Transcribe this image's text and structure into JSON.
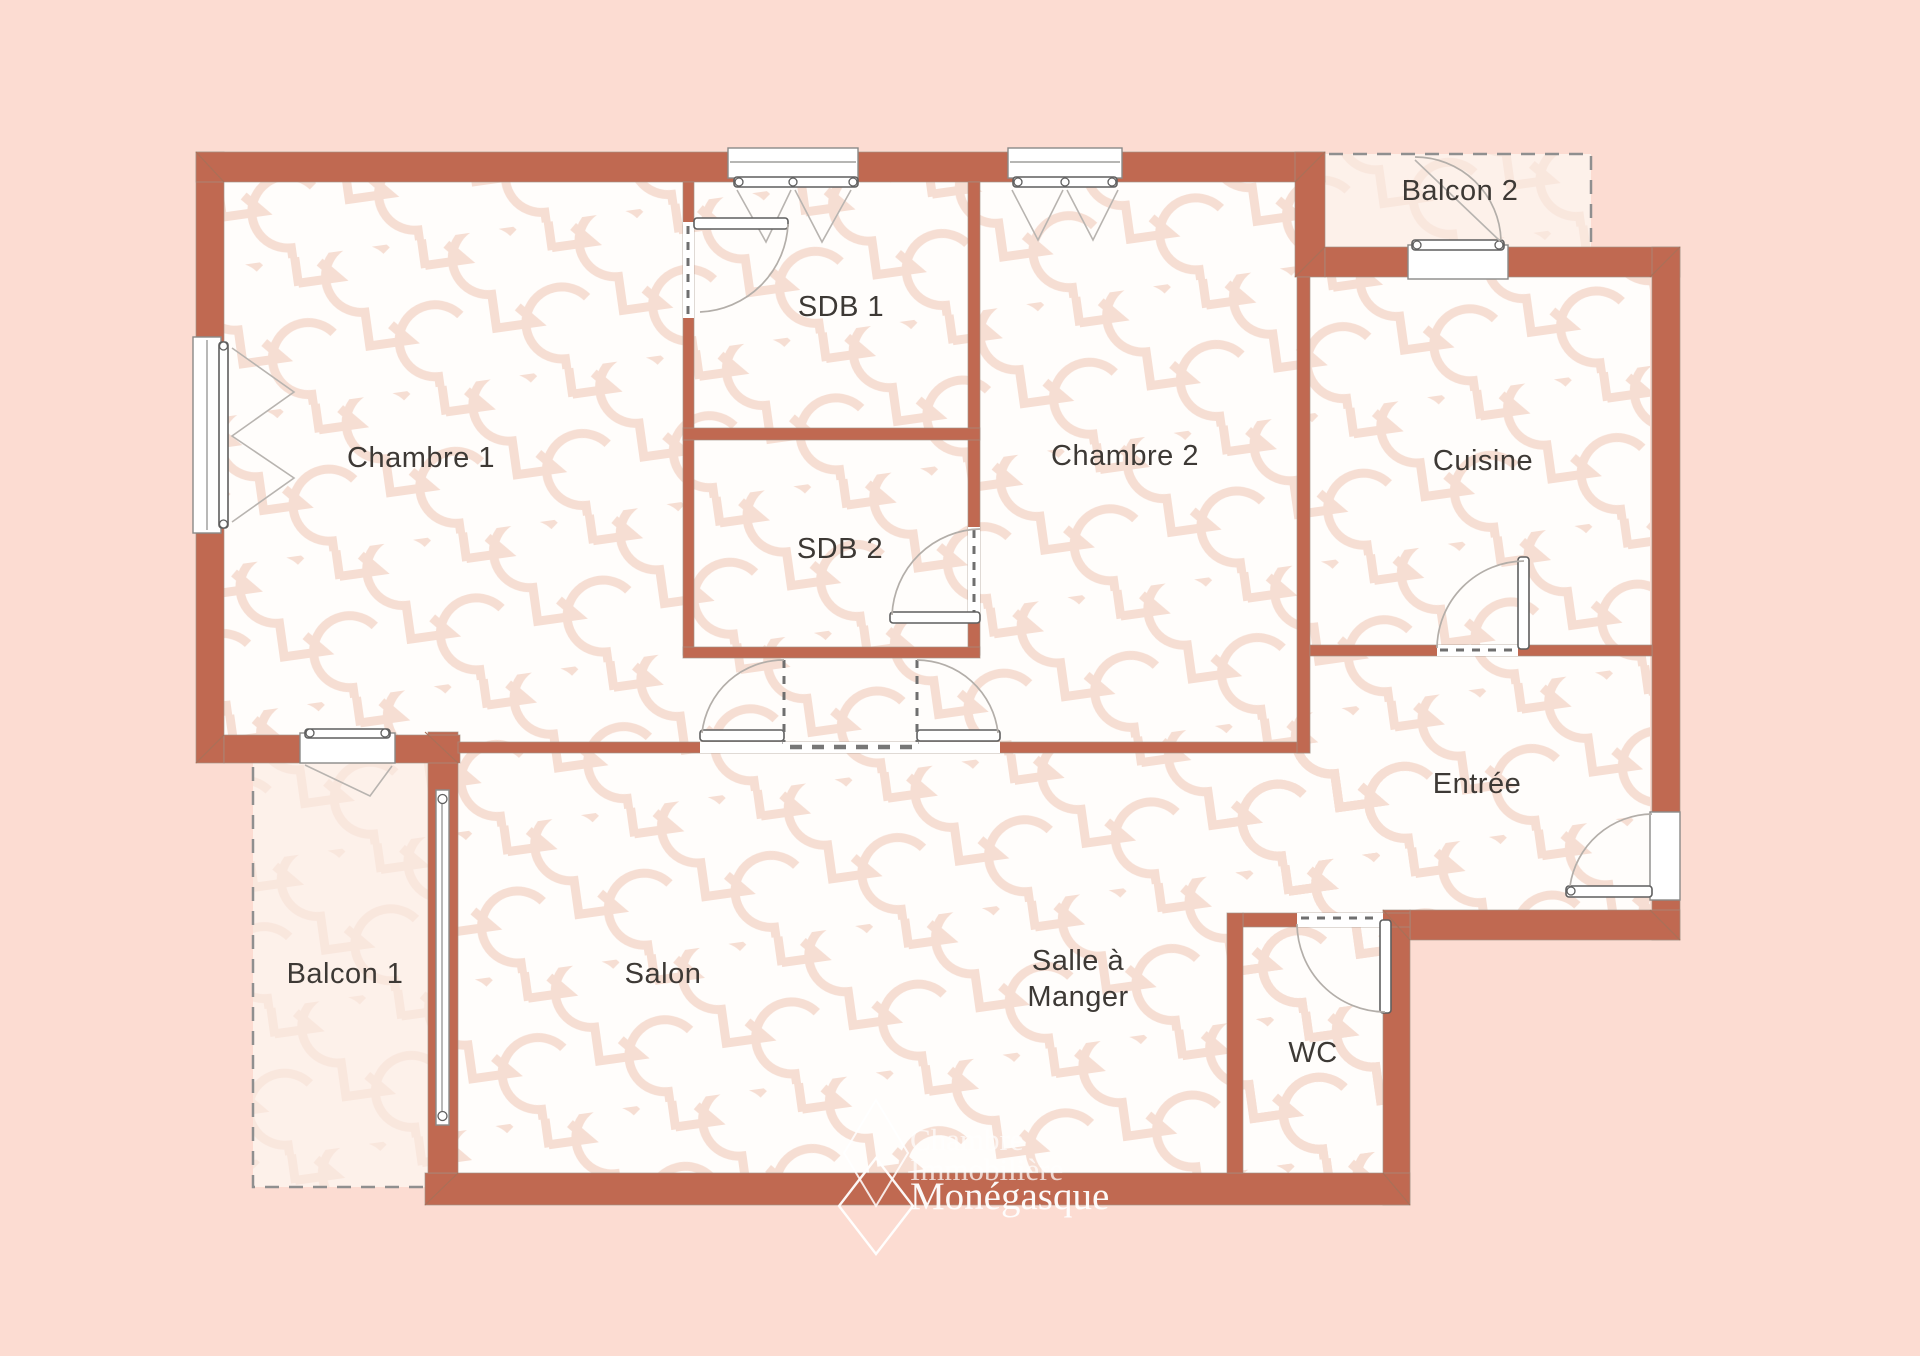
{
  "colors": {
    "background": "#fcdcd2",
    "wall": "#c06951",
    "floor": "#fffdfb",
    "balcony_floor": "#fdf1ea",
    "pattern": "#f6ded3",
    "label": "#3d3935",
    "watermark": "#ffffff"
  },
  "rooms": {
    "chambre1": {
      "label": "Chambre 1"
    },
    "sdb1": {
      "label": "SDB 1"
    },
    "sdb2": {
      "label": "SDB 2"
    },
    "chambre2": {
      "label": "Chambre 2"
    },
    "cuisine": {
      "label": "Cuisine"
    },
    "balcon2": {
      "label": "Balcon 2"
    },
    "entree": {
      "label": "Entrée"
    },
    "salon": {
      "label": "Salon"
    },
    "salle_a_manger": {
      "line1": "Salle à",
      "line2": "Manger"
    },
    "wc": {
      "label": "WC"
    },
    "balcon1": {
      "label": "Balcon 1"
    }
  },
  "watermark": {
    "line1": "Chambre",
    "line2": "Immobilière",
    "line3": "Monégasque"
  }
}
